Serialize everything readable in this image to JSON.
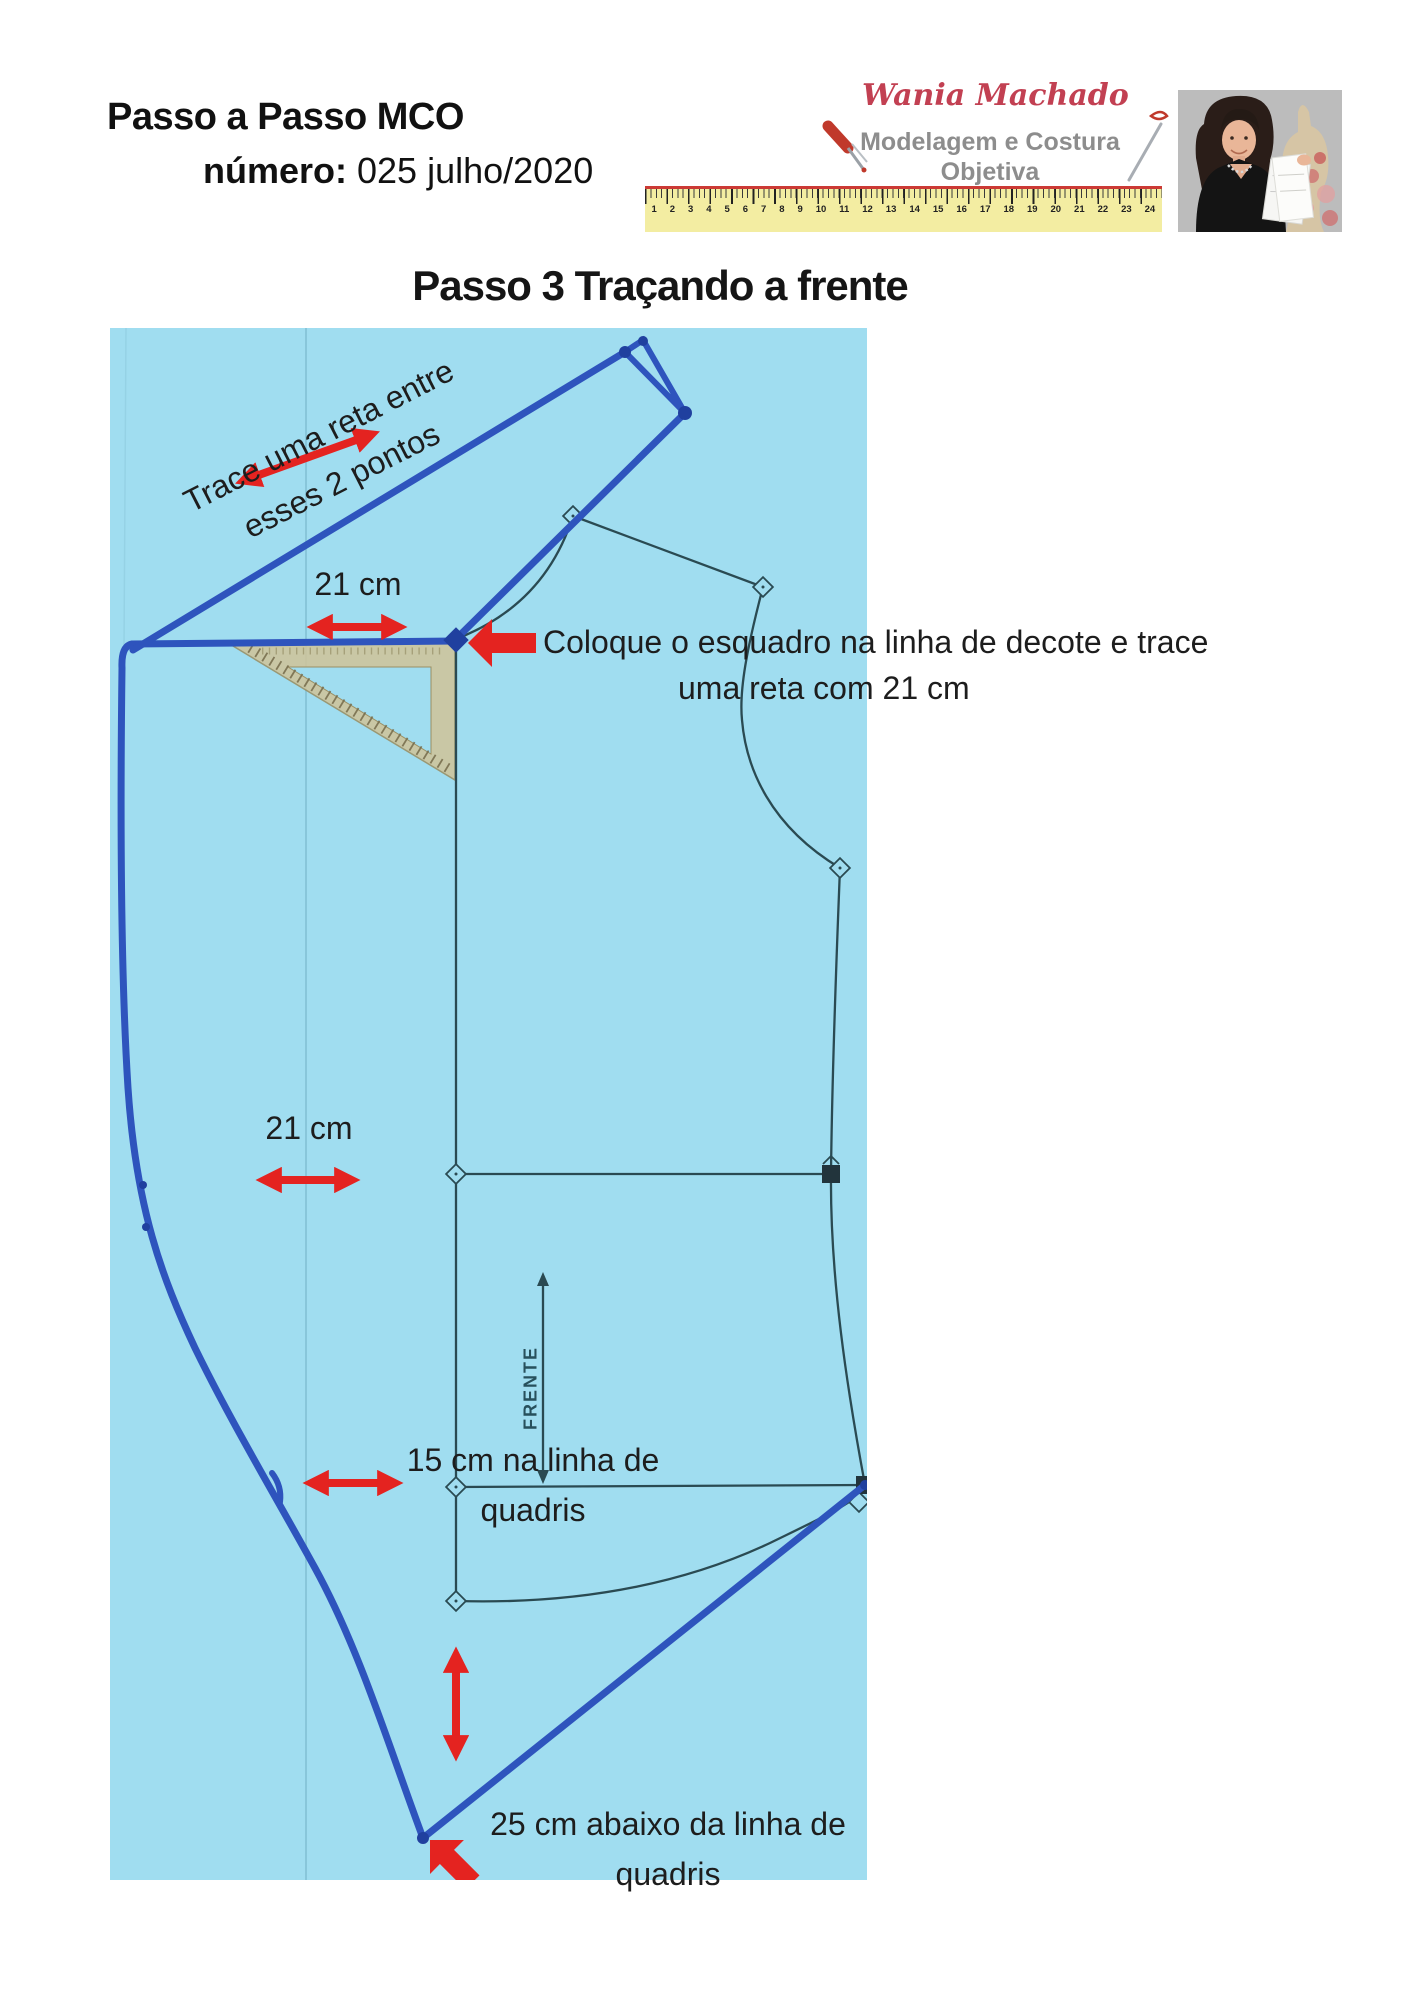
{
  "header": {
    "title": "Passo a Passo MCO",
    "numero_label": "número:",
    "numero_value": "025 julho/2020"
  },
  "logo": {
    "name": "Wania Machado",
    "tagline1": "Modelagem e Costura",
    "tagline2": "Objetiva",
    "ruler_numbers": [
      "1",
      "2",
      "3",
      "4",
      "5",
      "6",
      "7",
      "8",
      "9",
      "10",
      "11",
      "12",
      "13",
      "14",
      "15",
      "16",
      "17",
      "18",
      "19",
      "20",
      "21",
      "22",
      "23",
      "24"
    ]
  },
  "step_title": "Passo 3 Traçando a frente",
  "annotations": {
    "trace_line1": "Trace uma reta entre",
    "trace_line2": "esses 2 pontos",
    "measure_top": "21 cm",
    "esquadro_line1": "Coloque o esquadro na linha de decote e trace",
    "esquadro_line2": "uma reta com 21 cm",
    "measure_waist": "21 cm",
    "hip_line1": "15 cm na linha de",
    "hip_line2": "quadris",
    "below_hip_line1": "25  cm  abaixo da linha de",
    "below_hip_line2": "quadris",
    "frente": "FRENTE"
  },
  "colors": {
    "paper_blue": "#a0ddf0",
    "marker_blue": "#2e54bd",
    "marker_blue_dark": "#20409f",
    "pattern_line": "#2a4a52",
    "arrow_red": "#e42320",
    "logo_red": "#c24052",
    "logo_gray": "#8d8d8d",
    "ruler_yellow": "#f3eda2",
    "text_dark": "#1d1d1d"
  }
}
